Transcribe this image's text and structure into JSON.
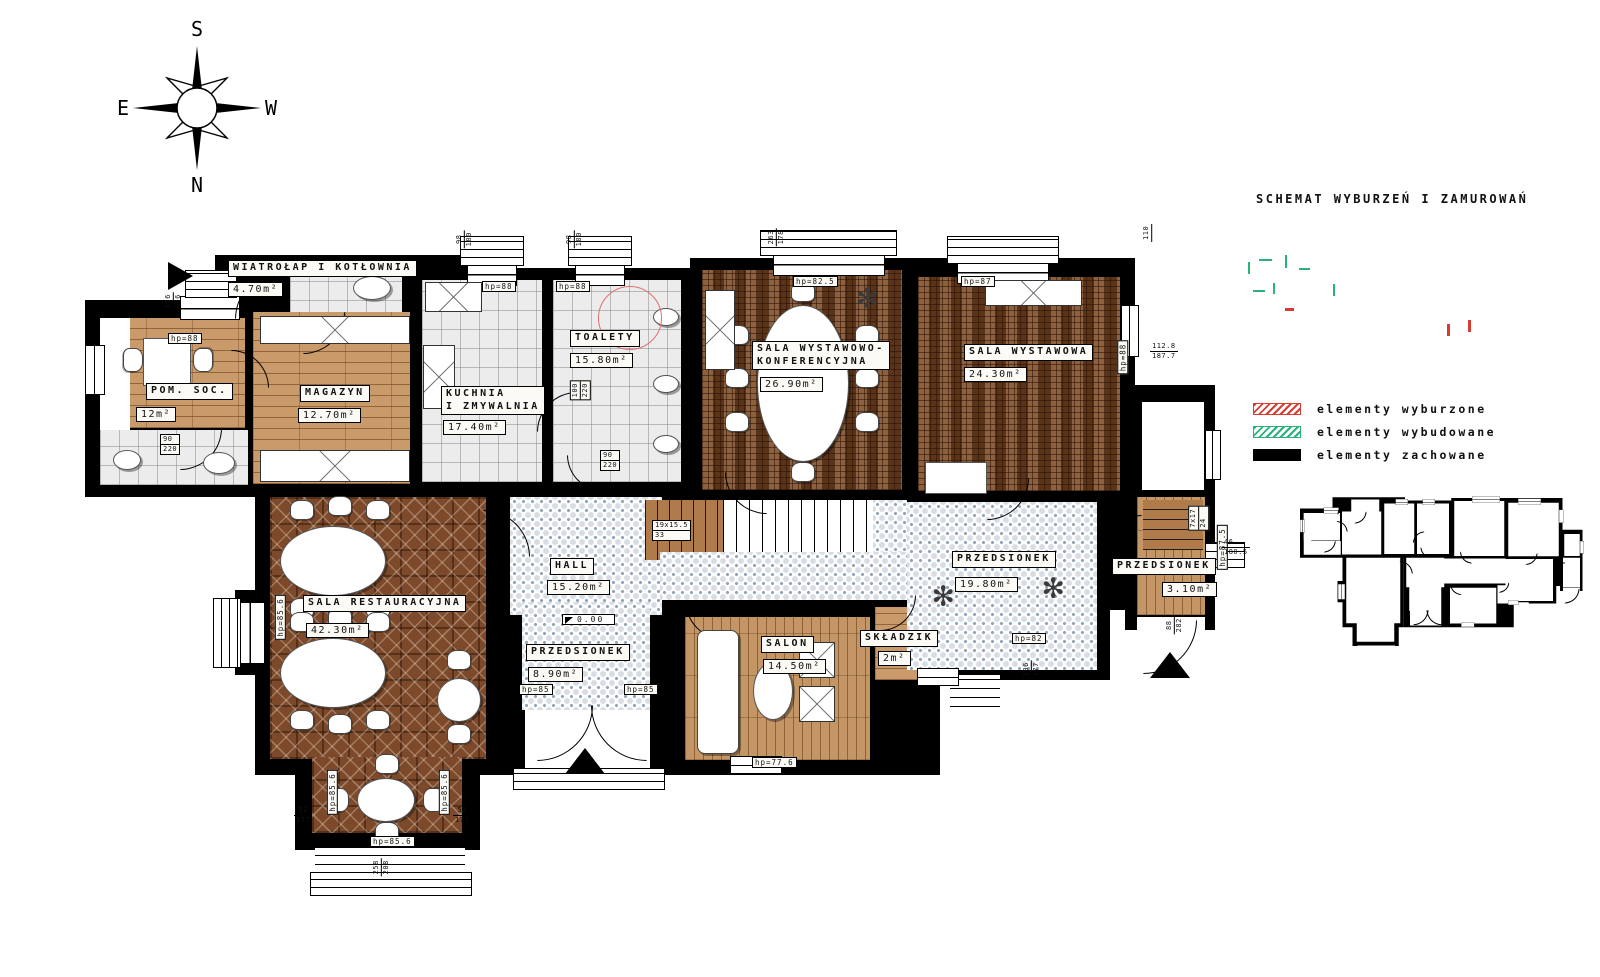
{
  "compass": {
    "n": "N",
    "s": "S",
    "e": "E",
    "w": "W"
  },
  "schematic": {
    "title": "SCHEMAT WYBURZEŃ I ZAMUROWAŃ"
  },
  "legend": {
    "items": [
      {
        "label": "elementy wyburzone",
        "color": "#d63c30"
      },
      {
        "label": "elementy wybudowane",
        "color": "#2ab27b"
      },
      {
        "label": "elementy zachowane",
        "color": "#000000"
      }
    ]
  },
  "rooms": [
    {
      "n": "WIATROŁAP I KOTŁOWNIA",
      "a": "4.70m²"
    },
    {
      "n": "POM. SOC.",
      "a": "12m²"
    },
    {
      "n": "MAGAZYN",
      "a": "12.70m²"
    },
    {
      "n1": "KUCHNIA",
      "n2": "I ZMYWALNIA",
      "a": "17.40m²"
    },
    {
      "n": "TOALETY",
      "a": "15.80m²"
    },
    {
      "n1": "SALA WYSTAWOWO-",
      "n2": "KONFERENCYJNA",
      "a": "26.90m²"
    },
    {
      "n": "SALA WYSTAWOWA",
      "a": "24.30m²"
    },
    {
      "n": "SALA RESTAURACYJNA",
      "a": "42.30m²"
    },
    {
      "n": "HALL",
      "a": "15.20m²"
    },
    {
      "n": "PRZEDSIONEK",
      "a": "8.90m²"
    },
    {
      "n": "SALON",
      "a": "14.50m²"
    },
    {
      "n": "SKŁADZIK",
      "a": "2m²"
    },
    {
      "n": "PRZEDSIONEK",
      "a": "19.80m²"
    },
    {
      "n": "PRZEDSIONEK",
      "a": "3.10m²"
    }
  ],
  "hps": [
    "hp=88",
    "hp=88",
    "hp=88",
    "hp=82.5",
    "hp=87",
    "hp=88",
    "hp=85.6",
    "hp=85.6",
    "hp=85.6",
    "hp=85.6",
    "hp=85",
    "hp=85",
    "hp=77.6",
    "hp=82",
    "hp=87.5"
  ],
  "dims": [
    {
      "a": "156",
      "b": "166"
    },
    {
      "a": "98",
      "b": "180"
    },
    {
      "a": "98",
      "b": "180"
    },
    {
      "a": "263",
      "b": "178"
    },
    {
      "a": "110",
      "b": ""
    },
    {
      "a": "112.8",
      "b": "187.7"
    },
    {
      "a": "46",
      "b": "180.5"
    },
    {
      "a": "52",
      "b": "177"
    },
    {
      "a": "52",
      "b": "177"
    },
    {
      "a": "258",
      "b": "208"
    },
    {
      "a": "106",
      "b": "177"
    },
    {
      "a": "88",
      "b": "282"
    },
    {
      "a": "90",
      "b": "220"
    },
    {
      "a": "90",
      "b": "220"
    },
    {
      "a": "100",
      "b": "220"
    },
    {
      "a": "19x15.5",
      "b": "33"
    },
    {
      "a": "7x17",
      "b": "24"
    }
  ],
  "level_marker": "0.00"
}
